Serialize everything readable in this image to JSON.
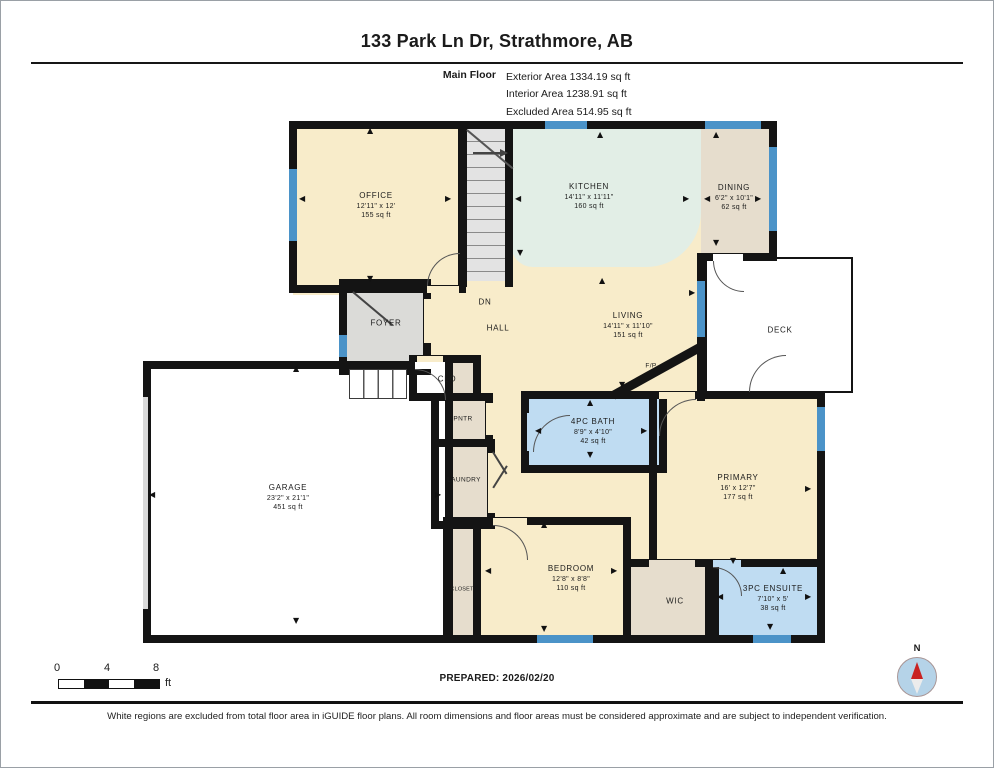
{
  "header": {
    "title": "133 Park Ln Dr, Strathmore, AB",
    "floor_label": "Main Floor",
    "exterior": "Exterior Area 1334.19 sq ft",
    "interior": "Interior Area 1238.91 sq ft",
    "excluded": "Excluded Area 514.95 sq ft"
  },
  "rooms": {
    "office": {
      "name": "OFFICE",
      "dims": "12'11\" x 12'",
      "area": "155 sq ft"
    },
    "kitchen": {
      "name": "KITCHEN",
      "dims": "14'11\" x 11'11\"",
      "area": "160 sq ft"
    },
    "dining": {
      "name": "DINING",
      "dims": "6'2\" x 10'1\"",
      "area": "62 sq ft"
    },
    "living": {
      "name": "LIVING",
      "dims": "14'11\" x 11'10\"",
      "area": "151 sq ft"
    },
    "deck": {
      "name": "DECK"
    },
    "foyer": {
      "name": "FOYER"
    },
    "hall": {
      "name": "HALL"
    },
    "stairs": {
      "name": "DN"
    },
    "clo": {
      "name": "CLO"
    },
    "pntr": {
      "name": "PNTR"
    },
    "laundry": {
      "name": "LAUNDRY"
    },
    "bath": {
      "name": "4PC BATH",
      "dims": "8'9\" x 4'10\"",
      "area": "42 sq ft"
    },
    "primary": {
      "name": "PRIMARY",
      "dims": "16' x 12'7\"",
      "area": "177 sq ft"
    },
    "garage": {
      "name": "GARAGE",
      "dims": "23'2\" x 21'1\"",
      "area": "451 sq ft"
    },
    "closet": {
      "name": "CLOSET"
    },
    "bedroom": {
      "name": "BEDROOM",
      "dims": "12'8\" x 8'8\"",
      "area": "110 sq ft"
    },
    "wic": {
      "name": "WIC"
    },
    "ensuite": {
      "name": "3PC ENSUITE",
      "dims": "7'10\" x 5'",
      "area": "38 sq ft"
    },
    "fireplace": {
      "name": "F/P"
    }
  },
  "colors": {
    "wall": "#141414",
    "room_cream": "#f8ecca",
    "room_tan": "#e6ddcd",
    "room_gray": "#dbdbd8",
    "room_green": "#e2eee6",
    "room_blue": "#bfdcf2",
    "window": "#4b93c8",
    "compass_needle": "#c92222"
  },
  "footer": {
    "prepared": "PREPARED: 2026/02/20",
    "disclaimer": "White regions are excluded from total floor area in iGUIDE floor plans. All room dimensions and floor areas must be considered approximate and are subject to independent verification.",
    "scale": {
      "t0": "0",
      "t4": "4",
      "t8": "8",
      "unit": "ft"
    },
    "compass": "N"
  }
}
